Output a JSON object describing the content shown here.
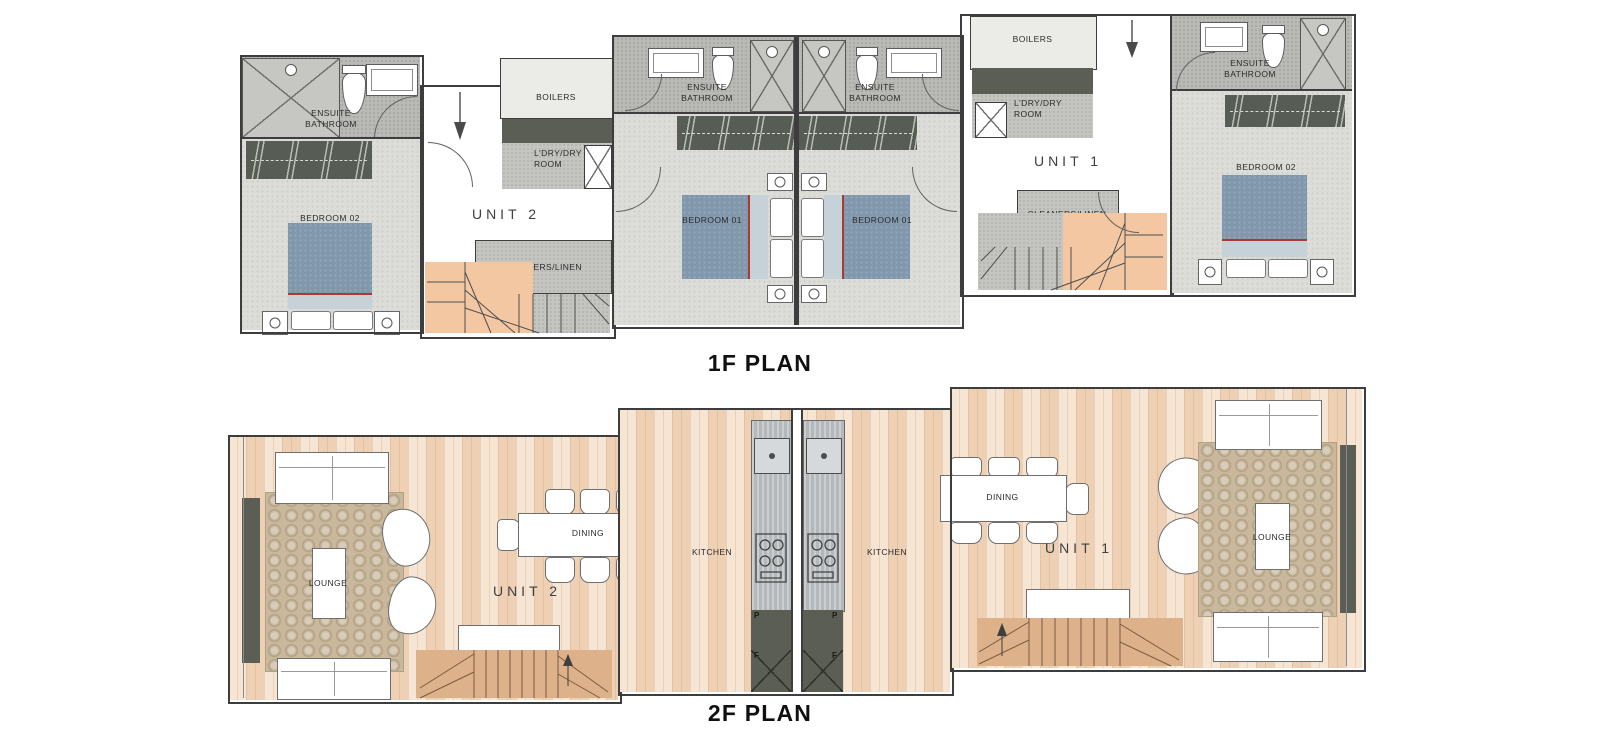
{
  "titles": {
    "f1": "1F PLAN",
    "f2": "2F PLAN"
  },
  "units": {
    "unit1": "UNIT 1",
    "unit2": "UNIT 2"
  },
  "rooms": {
    "ensuite_bathroom": "ENSUITE BATHROOM",
    "bedroom_01": "BEDROOM 01",
    "bedroom_02": "BEDROOM 02",
    "boilers": "BOILERS",
    "laundry_dry_room": "L'DRY/DRY ROOM",
    "cleaners_linen": "CLEANERS/LINEN",
    "lounge": "LOUNGE",
    "dining": "DINING",
    "kitchen": "KITCHEN"
  },
  "kitchen_units": {
    "pantry": "P",
    "fridge": "F"
  },
  "palette": {
    "wall": "#3d3d3d",
    "carpet_floor": "#dcdcd8",
    "bathroom_floor": "#b9b9b6",
    "utility_floor": "#c4c4c1",
    "boiler_floor": "#ebebe8",
    "wood_floor": "#f4dcc4",
    "stair_1f": "#f2c7a2",
    "stair_2f": "#ddb18a",
    "rug": "#c9b89b",
    "kitchen_steel": "#bcc0c2",
    "dark_joinery": "#5a5e55",
    "bed_blue": "#8197ac",
    "bed_throw_red": "#ac3a34"
  }
}
